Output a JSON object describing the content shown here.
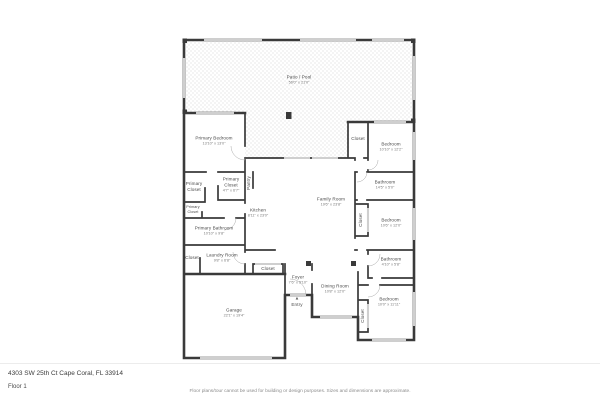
{
  "meta": {
    "address": "4303 SW 25th Ct Cape Coral, FL 33914",
    "floor_label": "Floor 1",
    "disclaimer": "Floor plans/tour cannot be used for building or design purposes. Sizes and dimensions are approximate."
  },
  "colors": {
    "wall": "#3a3a3a",
    "window": "#cfcfcf",
    "patio_dot": "#d8d8d8",
    "label": "#4a4a4a"
  },
  "rooms": [
    {
      "name": "Patio / Pool",
      "dims": "56'0\" x 21'0\""
    },
    {
      "name": "Primary Bedroom",
      "dims": "13'10\" x 13'0\""
    },
    {
      "name": "Closet",
      "dims": ""
    },
    {
      "name": "Bedroom",
      "dims": "10'10\" x 12'2\""
    },
    {
      "name": "Bathroom",
      "dims": "14'5\" x 5'0\""
    },
    {
      "name": "Bedroom",
      "dims": "10'6\" x 12'0\""
    },
    {
      "name": "Closet",
      "dims": ""
    },
    {
      "name": "Family Room",
      "dims": "19'6\" x 23'8\""
    },
    {
      "name": "Kitchen",
      "dims": "8'11\" x 23'0\""
    },
    {
      "name": "Primary Closet",
      "dims": ""
    },
    {
      "name": "Primary Closet",
      "dims": "4'7\" x 6'7\""
    },
    {
      "name": "Pantry",
      "dims": ""
    },
    {
      "name": "Primary Closet",
      "dims": ""
    },
    {
      "name": "Primary Bathroom",
      "dims": "10'10\" x 9'8\""
    },
    {
      "name": "Closet",
      "dims": ""
    },
    {
      "name": "Laundry Room",
      "dims": "9'8\" x 6'8\""
    },
    {
      "name": "Garage",
      "dims": "22'1\" x 19'4\""
    },
    {
      "name": "Closet",
      "dims": ""
    },
    {
      "name": "Foyer",
      "dims": "7'6\" x 5'10\""
    },
    {
      "name": "Entry",
      "dims": ""
    },
    {
      "name": "Dining Room",
      "dims": "10'8\" x 12'0\""
    },
    {
      "name": "Bathroom",
      "dims": "4'10\" x 5'8\""
    },
    {
      "name": "Bedroom",
      "dims": "10'0\" x 11'11\""
    },
    {
      "name": "Closet",
      "dims": ""
    }
  ],
  "icons": {
    "entry_arrow": "▲"
  }
}
